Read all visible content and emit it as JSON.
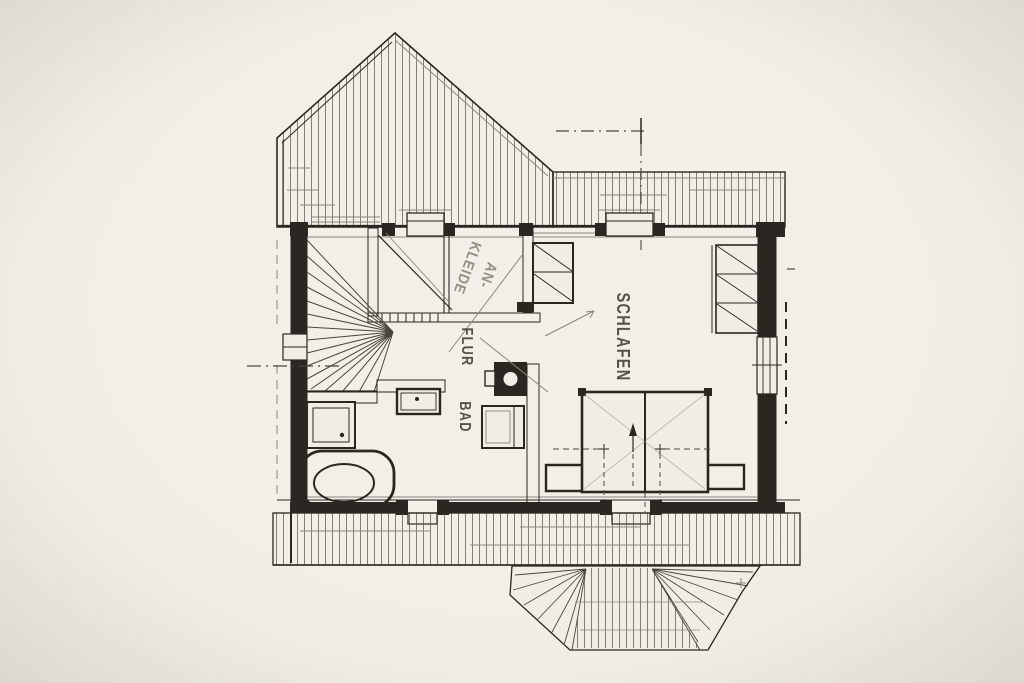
{
  "drawing": {
    "type": "floor-plan-sketch",
    "rooms": {
      "schlafen": {
        "label": "SCHLAFEN"
      },
      "flur": {
        "label": "FLUR"
      },
      "bad": {
        "label": "BAD"
      },
      "ankleide": {
        "label_line1": "AN-",
        "label_line2": "KLEIDE"
      }
    },
    "colors": {
      "paper": "#f0ede7",
      "ink": "#2a2722",
      "pencil": "#8d8679",
      "hatch": "#57534b",
      "faint": "#4a463f"
    }
  }
}
